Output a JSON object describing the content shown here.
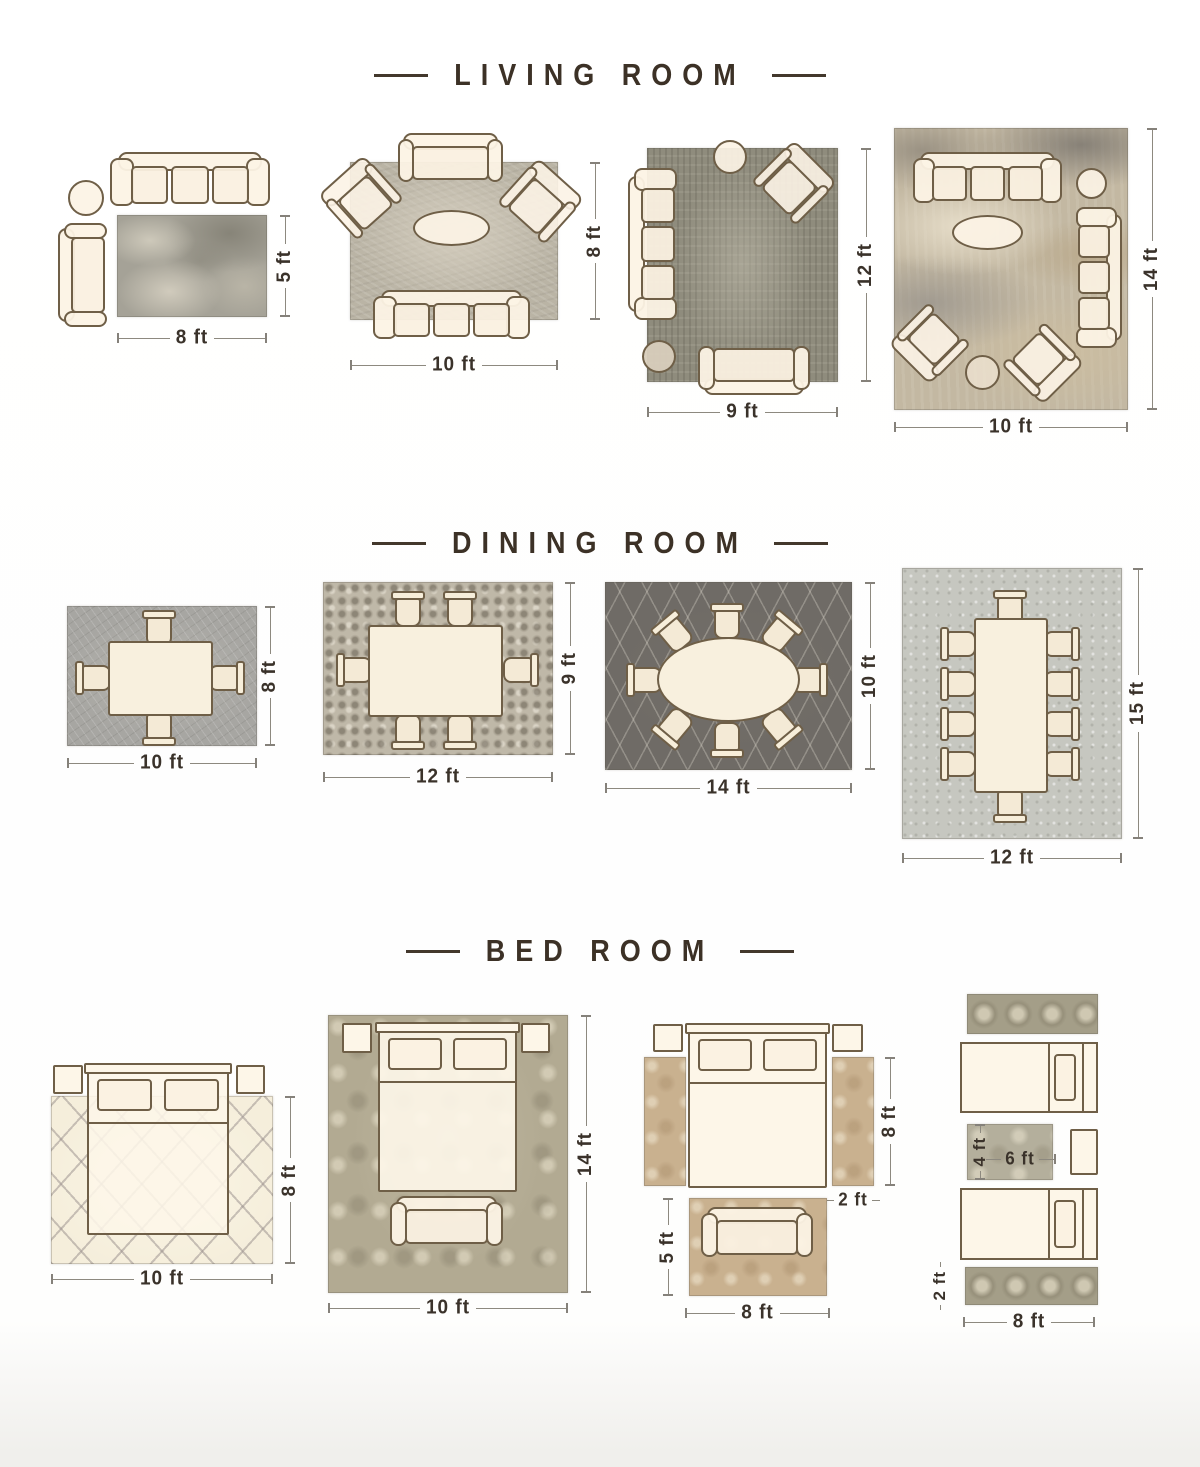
{
  "page": {
    "background": "#ffffff"
  },
  "palette": {
    "title_text": "#3c3126",
    "dimension_text": "#3a322a",
    "furniture_outline": "#6f5f47",
    "furniture_fill": "#fbf2e4"
  },
  "sections": [
    {
      "title": "LIVING ROOM",
      "diagrams": [
        {
          "id": "living-8x5",
          "rug_width": "8 ft",
          "rug_height": "5 ft"
        },
        {
          "id": "living-10x8",
          "rug_width": "10 ft",
          "rug_height": "8 ft"
        },
        {
          "id": "living-9x12",
          "rug_width": "9 ft",
          "rug_height": "12 ft"
        },
        {
          "id": "living-10x14",
          "rug_width": "10 ft",
          "rug_height": "14 ft"
        }
      ]
    },
    {
      "title": "DINING ROOM",
      "diagrams": [
        {
          "id": "dining-10x8",
          "rug_width": "10 ft",
          "rug_height": "8 ft"
        },
        {
          "id": "dining-12x9",
          "rug_width": "12 ft",
          "rug_height": "9 ft"
        },
        {
          "id": "dining-14x10",
          "rug_width": "14 ft",
          "rug_height": "10 ft"
        },
        {
          "id": "dining-12x15",
          "rug_width": "12 ft",
          "rug_height": "15 ft"
        }
      ]
    },
    {
      "title": "BED ROOM",
      "diagrams": [
        {
          "id": "bed-10x8",
          "rug_width": "10 ft",
          "rug_height": "8 ft"
        },
        {
          "id": "bed-10x14",
          "rug_width": "10 ft",
          "rug_height": "14 ft"
        },
        {
          "id": "bed-side-runners",
          "runner_length": "8 ft",
          "runner_width": "2 ft",
          "foot_rug_height": "5 ft",
          "foot_rug_width": "8 ft"
        },
        {
          "id": "bed-twin-runners",
          "middle_rug_height": "4 ft",
          "middle_rug_width": "6 ft",
          "runner_width": "2 ft",
          "runner_length": "8 ft"
        }
      ]
    }
  ]
}
